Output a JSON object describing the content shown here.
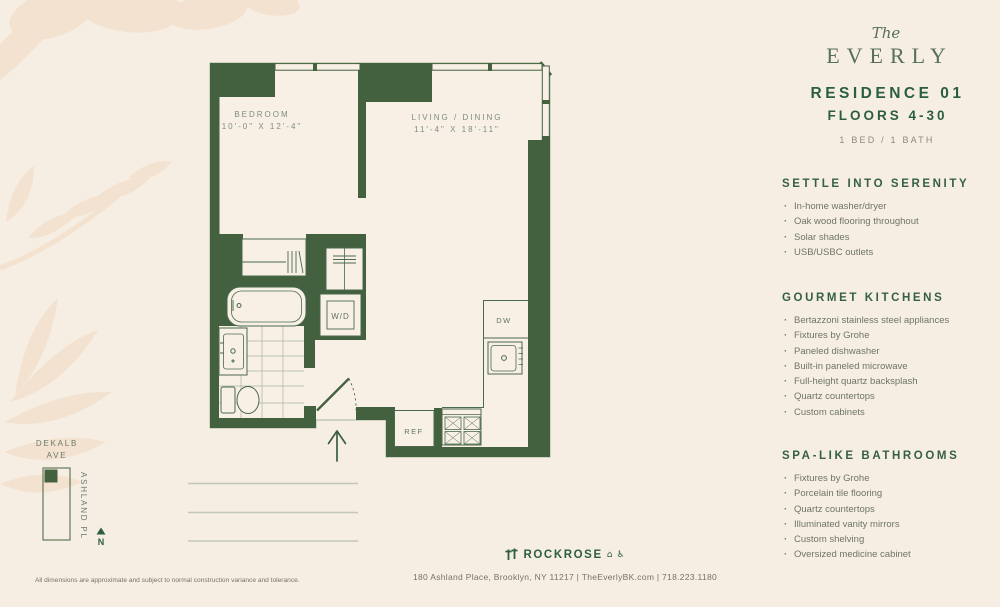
{
  "brand": {
    "pre": "The",
    "name": "EVERLY"
  },
  "header": {
    "residence": "RESIDENCE 01",
    "floors": "FLOORS 4-30",
    "bed_bath": "1 BED / 1 BATH"
  },
  "sections": [
    {
      "title": "SETTLE INTO SERENITY",
      "items": [
        "In-home washer/dryer",
        "Oak wood flooring throughout",
        "Solar shades",
        "USB/USBC outlets"
      ]
    },
    {
      "title": "GOURMET KITCHENS",
      "items": [
        "Bertazzoni stainless steel appliances",
        "Fixtures by Grohe",
        "Paneled dishwasher",
        "Built-in paneled microwave",
        "Full-height quartz backsplash",
        "Quartz countertops",
        "Custom cabinets"
      ]
    },
    {
      "title": "SPA-LIKE BATHROOMS",
      "items": [
        "Fixtures by Grohe",
        "Porcelain tile flooring",
        "Quartz countertops",
        "Illuminated vanity mirrors",
        "Custom shelving",
        "Oversized medicine cabinet"
      ]
    }
  ],
  "plan": {
    "bedroom_name": "BEDROOM",
    "bedroom_dims": "10'-0\" X 12'-4\"",
    "living_name": "LIVING / DINING",
    "living_dims": "11'-4\" X 18'-11\"",
    "wd": "W/D",
    "dw": "DW",
    "ref": "REF"
  },
  "map": {
    "street_top_line1": "DEKALB",
    "street_top_line2": "AVE",
    "street_side": "ASHLAND PL",
    "north": "N"
  },
  "footer": {
    "disclaimer": "All dimensions are approximate and subject to normal construction variance and tolerance.",
    "developer": "ROCKROSE",
    "address": "180 Ashland Place, Brooklyn, NY 11217  |  TheEverlyBK.com  |  718.223.1180"
  },
  "colors": {
    "background": "#f7eee3",
    "wall_green": "#44613f",
    "heading_green": "#2b5f3b",
    "body_text": "#6d7565",
    "leaf": "#f2e2cf"
  }
}
